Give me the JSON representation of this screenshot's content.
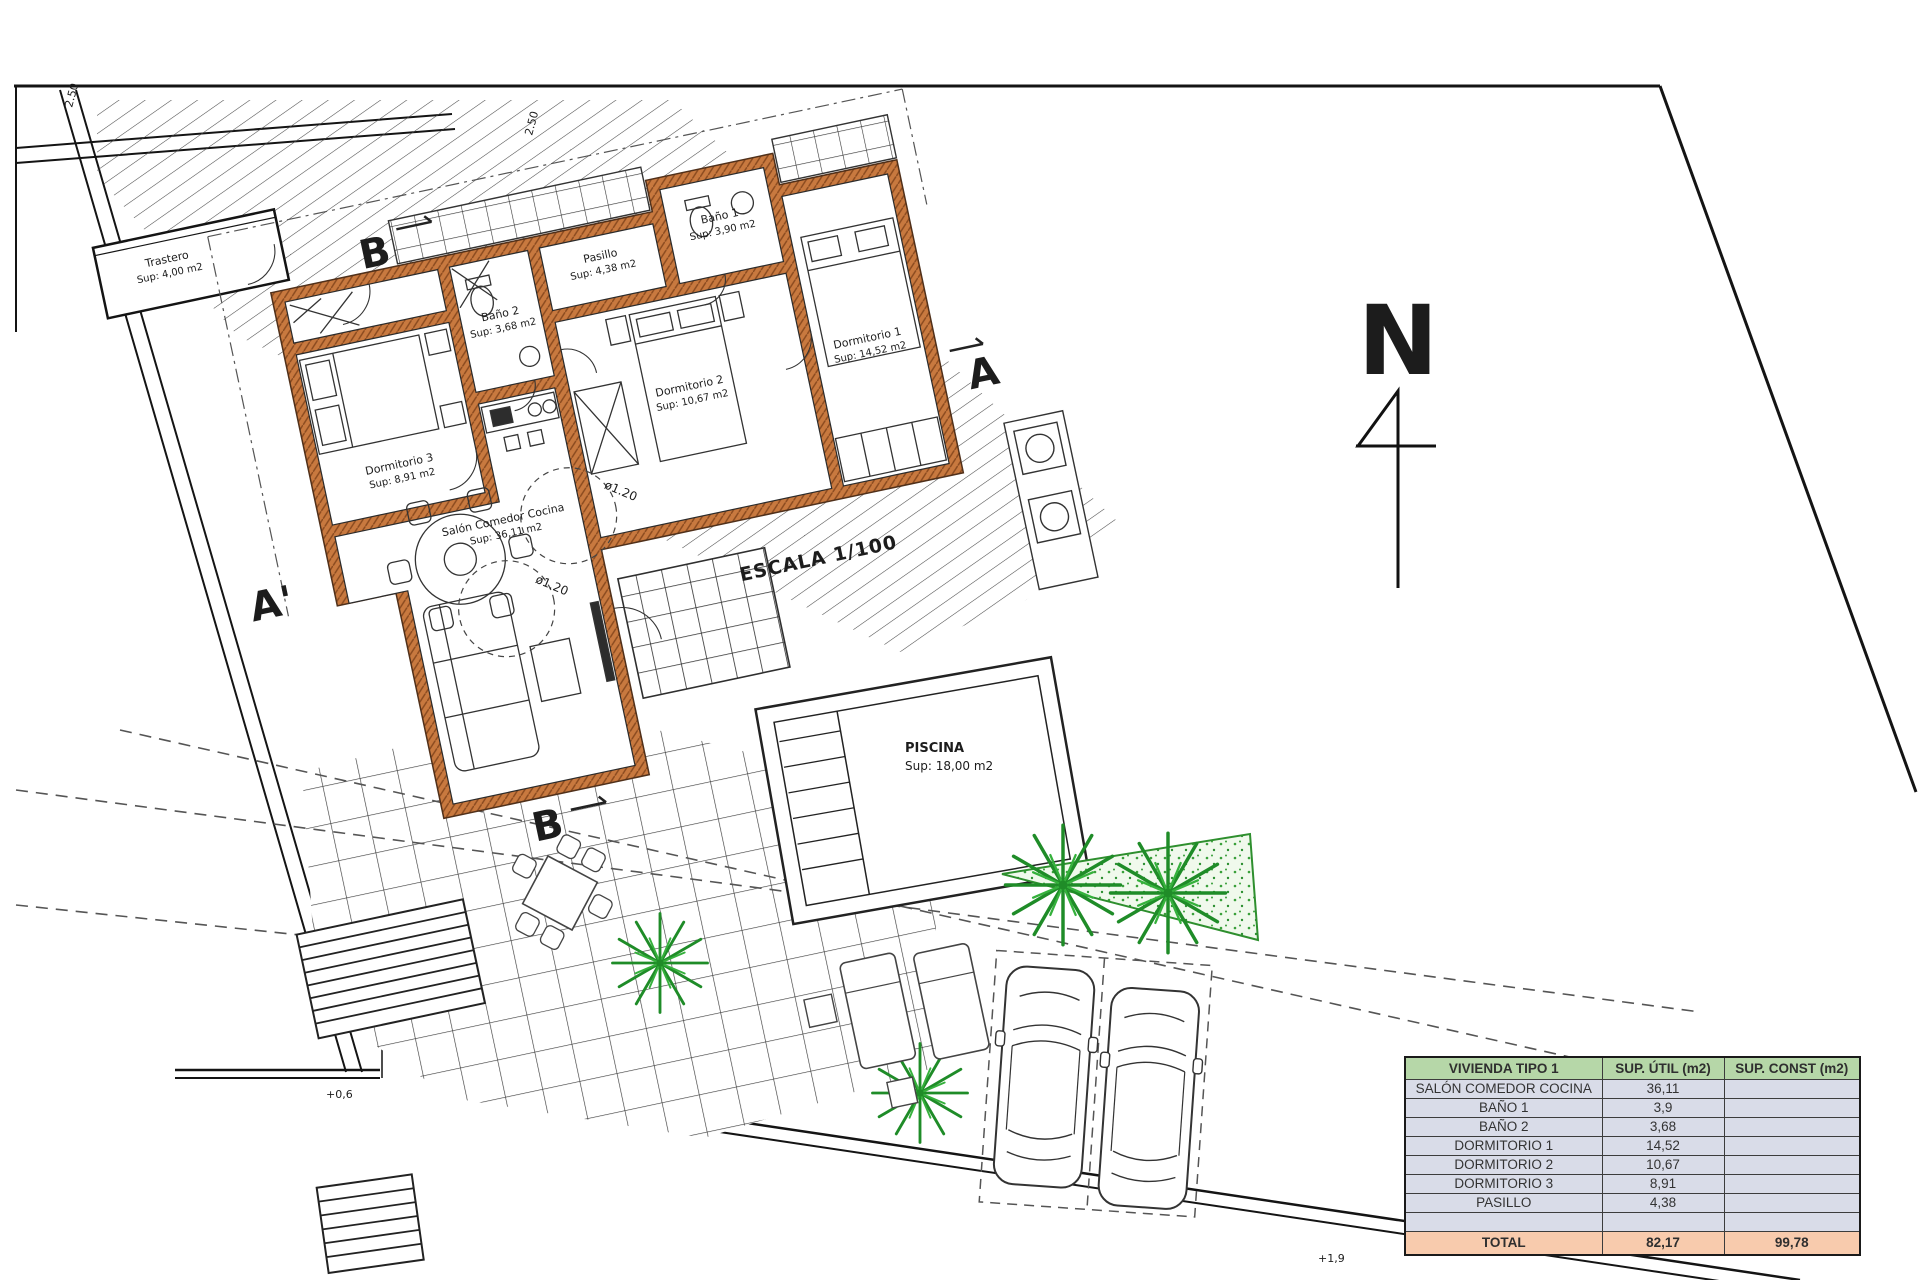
{
  "drawing": {
    "scale_label": "ESCALA 1/100",
    "north_label": "N",
    "rooms": [
      {
        "name": "Trastero",
        "area": "Sup: 4,00 m2"
      },
      {
        "name": "Pasillo",
        "area": "Sup: 4,38 m2"
      },
      {
        "name": "Baño 1",
        "area": "Sup: 3,90 m2"
      },
      {
        "name": "Baño 2",
        "area": "Sup: 3,68 m2"
      },
      {
        "name": "Dormitorio 3",
        "area": "Sup: 8,91 m2"
      },
      {
        "name": "Dormitorio 2",
        "area": "Sup: 10,67 m2"
      },
      {
        "name": "Dormitorio 1",
        "area": "Sup: 14,52 m2"
      },
      {
        "name": "Salón Comedor Cocina",
        "area": "Sup: 36,11 m2"
      },
      {
        "name": "PISCINA",
        "area": "Sup: 18,00 m2"
      }
    ],
    "section_markers": {
      "a": "A",
      "a_prime": "A'",
      "b_top": "B",
      "b_bottom": "B"
    },
    "diameter_label": "ø1.20",
    "dimension_label": "2.50",
    "level_markers": {
      "left": "+0,6",
      "right": "+1,9"
    },
    "colors": {
      "wall": "#c8793f",
      "vegetation": "#249b2f",
      "hatch": "#444444"
    }
  },
  "table": {
    "header": {
      "col1": "VIVIENDA TIPO 1",
      "col2": "SUP. ÚTIL (m2)",
      "col3": "SUP. CONST (m2)"
    },
    "rows": [
      {
        "name": "SALÓN COMEDOR COCINA",
        "util": "36,11",
        "const": ""
      },
      {
        "name": "BAÑO 1",
        "util": "3,9",
        "const": ""
      },
      {
        "name": "BAÑO 2",
        "util": "3,68",
        "const": ""
      },
      {
        "name": "DORMITORIO 1",
        "util": "14,52",
        "const": ""
      },
      {
        "name": "DORMITORIO 2",
        "util": "10,67",
        "const": ""
      },
      {
        "name": "DORMITORIO 3",
        "util": "8,91",
        "const": ""
      },
      {
        "name": "PASILLO",
        "util": "4,38",
        "const": ""
      },
      {
        "name": "",
        "util": "",
        "const": ""
      }
    ],
    "total": {
      "name": "TOTAL",
      "util": "82,17",
      "const": "99,78"
    },
    "colors": {
      "header_bg": "#b6d7a8",
      "row_bg": "#d9dce8",
      "total_bg": "#f8cbad"
    }
  }
}
